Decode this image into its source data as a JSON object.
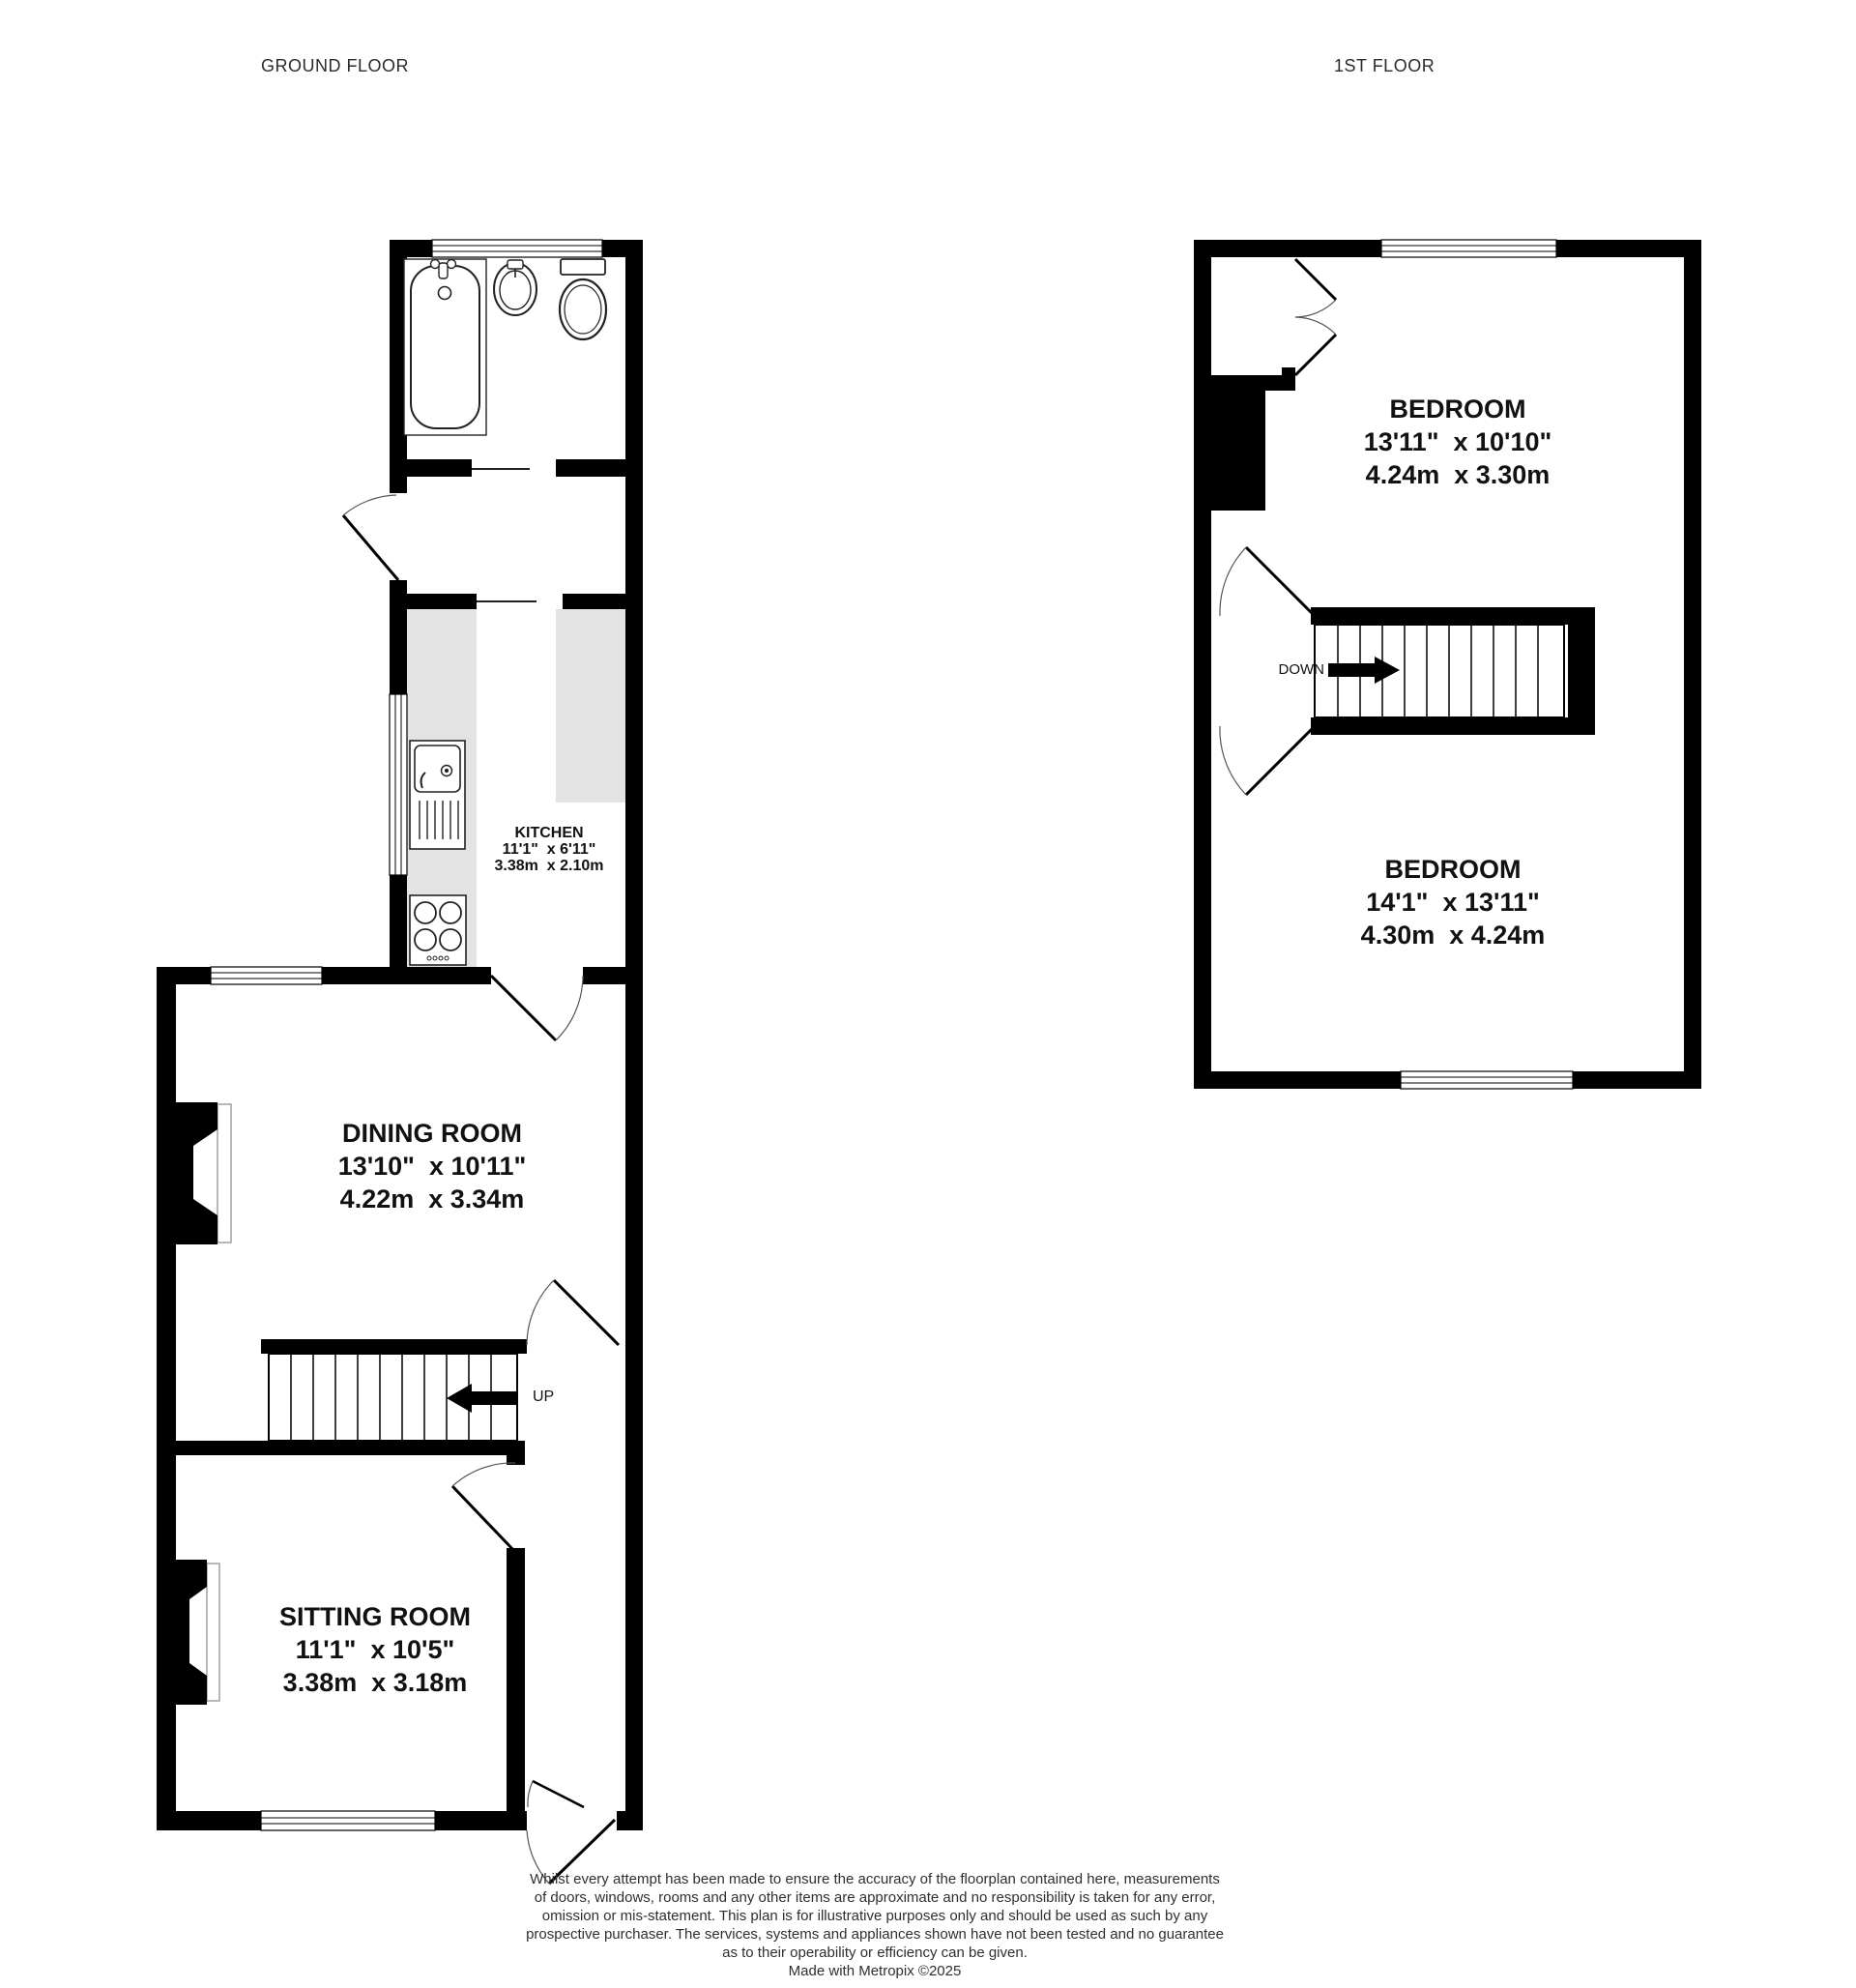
{
  "header": {
    "ground_floor": "GROUND FLOOR",
    "first_floor": "1ST FLOOR"
  },
  "rooms": {
    "kitchen": {
      "name": "KITCHEN",
      "imperial": "11'1\"  x 6'11\"",
      "metric": "3.38m  x 2.10m"
    },
    "dining_room": {
      "name": "DINING ROOM",
      "imperial": "13'10\"  x 10'11\"",
      "metric": "4.22m  x 3.34m"
    },
    "sitting_room": {
      "name": "SITTING ROOM",
      "imperial": "11'1\"  x 10'5\"",
      "metric": "3.38m  x 3.18m"
    },
    "bedroom_1": {
      "name": "BEDROOM",
      "imperial": "13'11\"  x 10'10\"",
      "metric": "4.24m  x 3.30m"
    },
    "bedroom_2": {
      "name": "BEDROOM",
      "imperial": "14'1\"  x 13'11\"",
      "metric": "4.30m  x 4.24m"
    }
  },
  "stairs": {
    "up_label": "UP",
    "down_label": "DOWN"
  },
  "disclaimer": {
    "line1": "Whilst every attempt has been made to ensure the accuracy of the floorplan contained here, measurements",
    "line2": "of doors, windows, rooms and any other items are approximate and no responsibility is taken for any error,",
    "line3": "omission or mis-statement. This plan is for illustrative purposes only and should be used as such by any",
    "line4": "prospective purchaser. The services, systems and appliances shown have not been tested and no guarantee",
    "line5": "as to their operability or efficiency can be given.",
    "credit": "Made with Metropix ©2025"
  },
  "colors": {
    "wall": "#000000",
    "counter": "#e3e3e3",
    "window_line": "#000000",
    "arc": "#555555"
  }
}
